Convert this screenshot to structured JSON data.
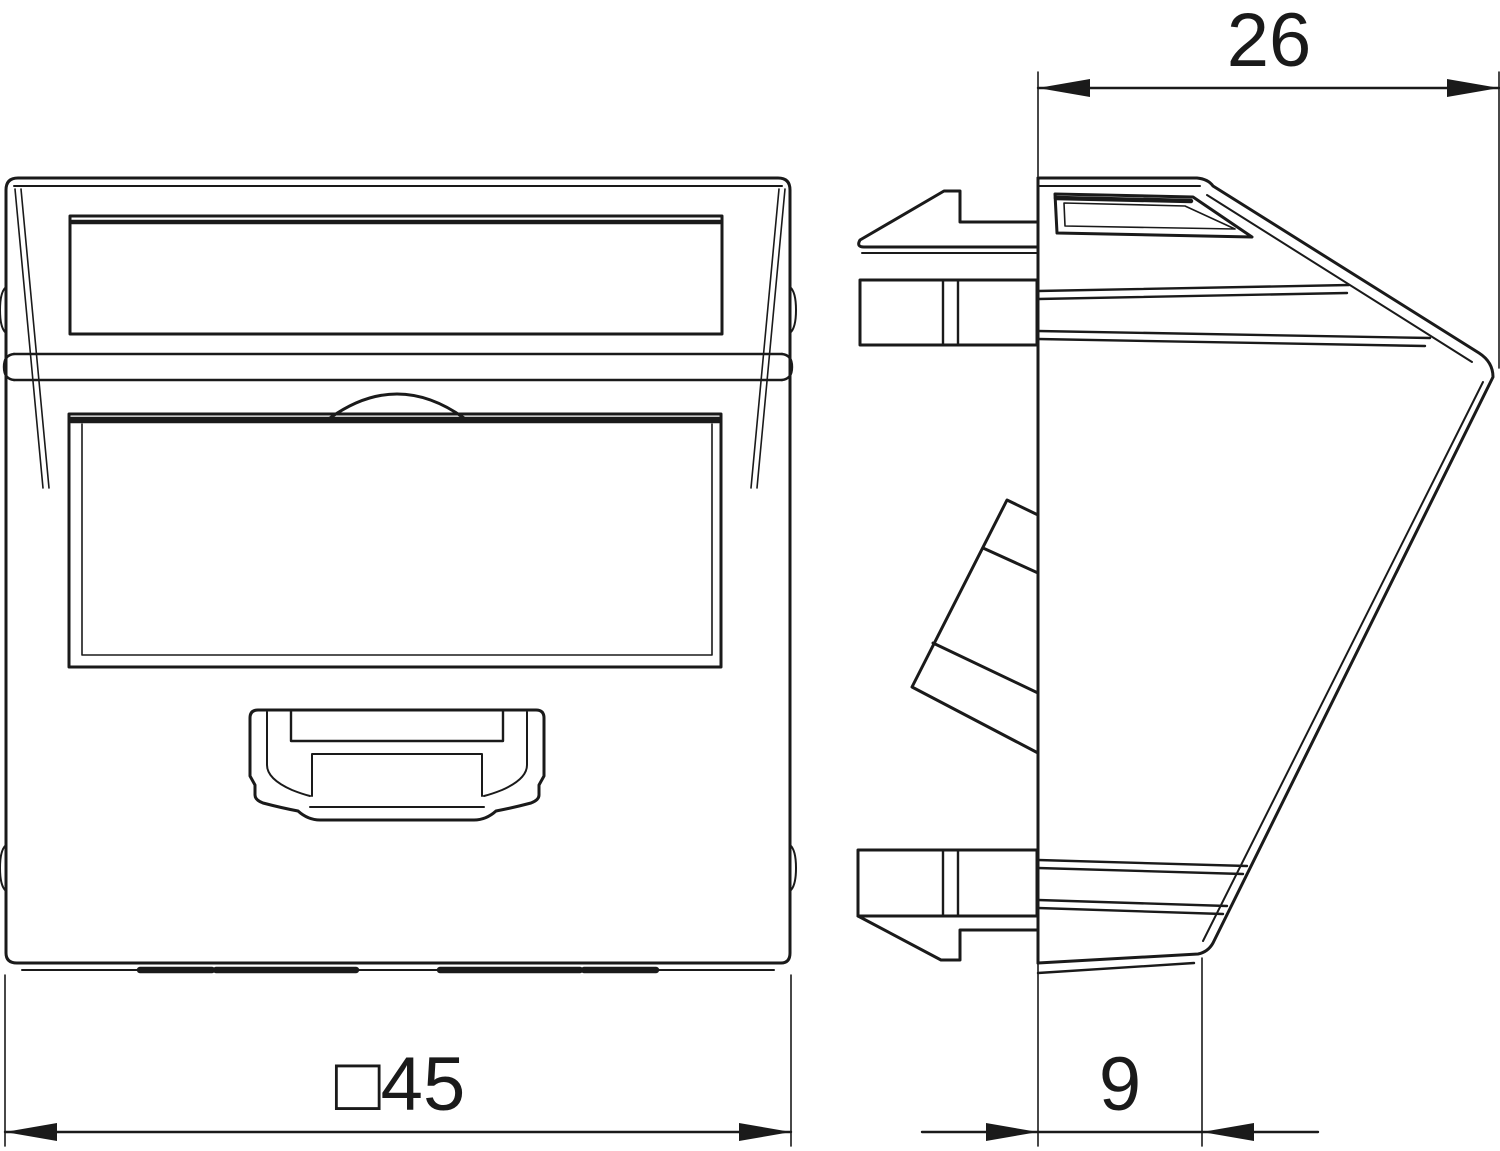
{
  "colors": {
    "line": "#1a1a1a",
    "background": "#ffffff"
  },
  "dimensions": {
    "side_top_width": "26",
    "front_square_size": "□45",
    "side_bottom_depth": "9"
  }
}
